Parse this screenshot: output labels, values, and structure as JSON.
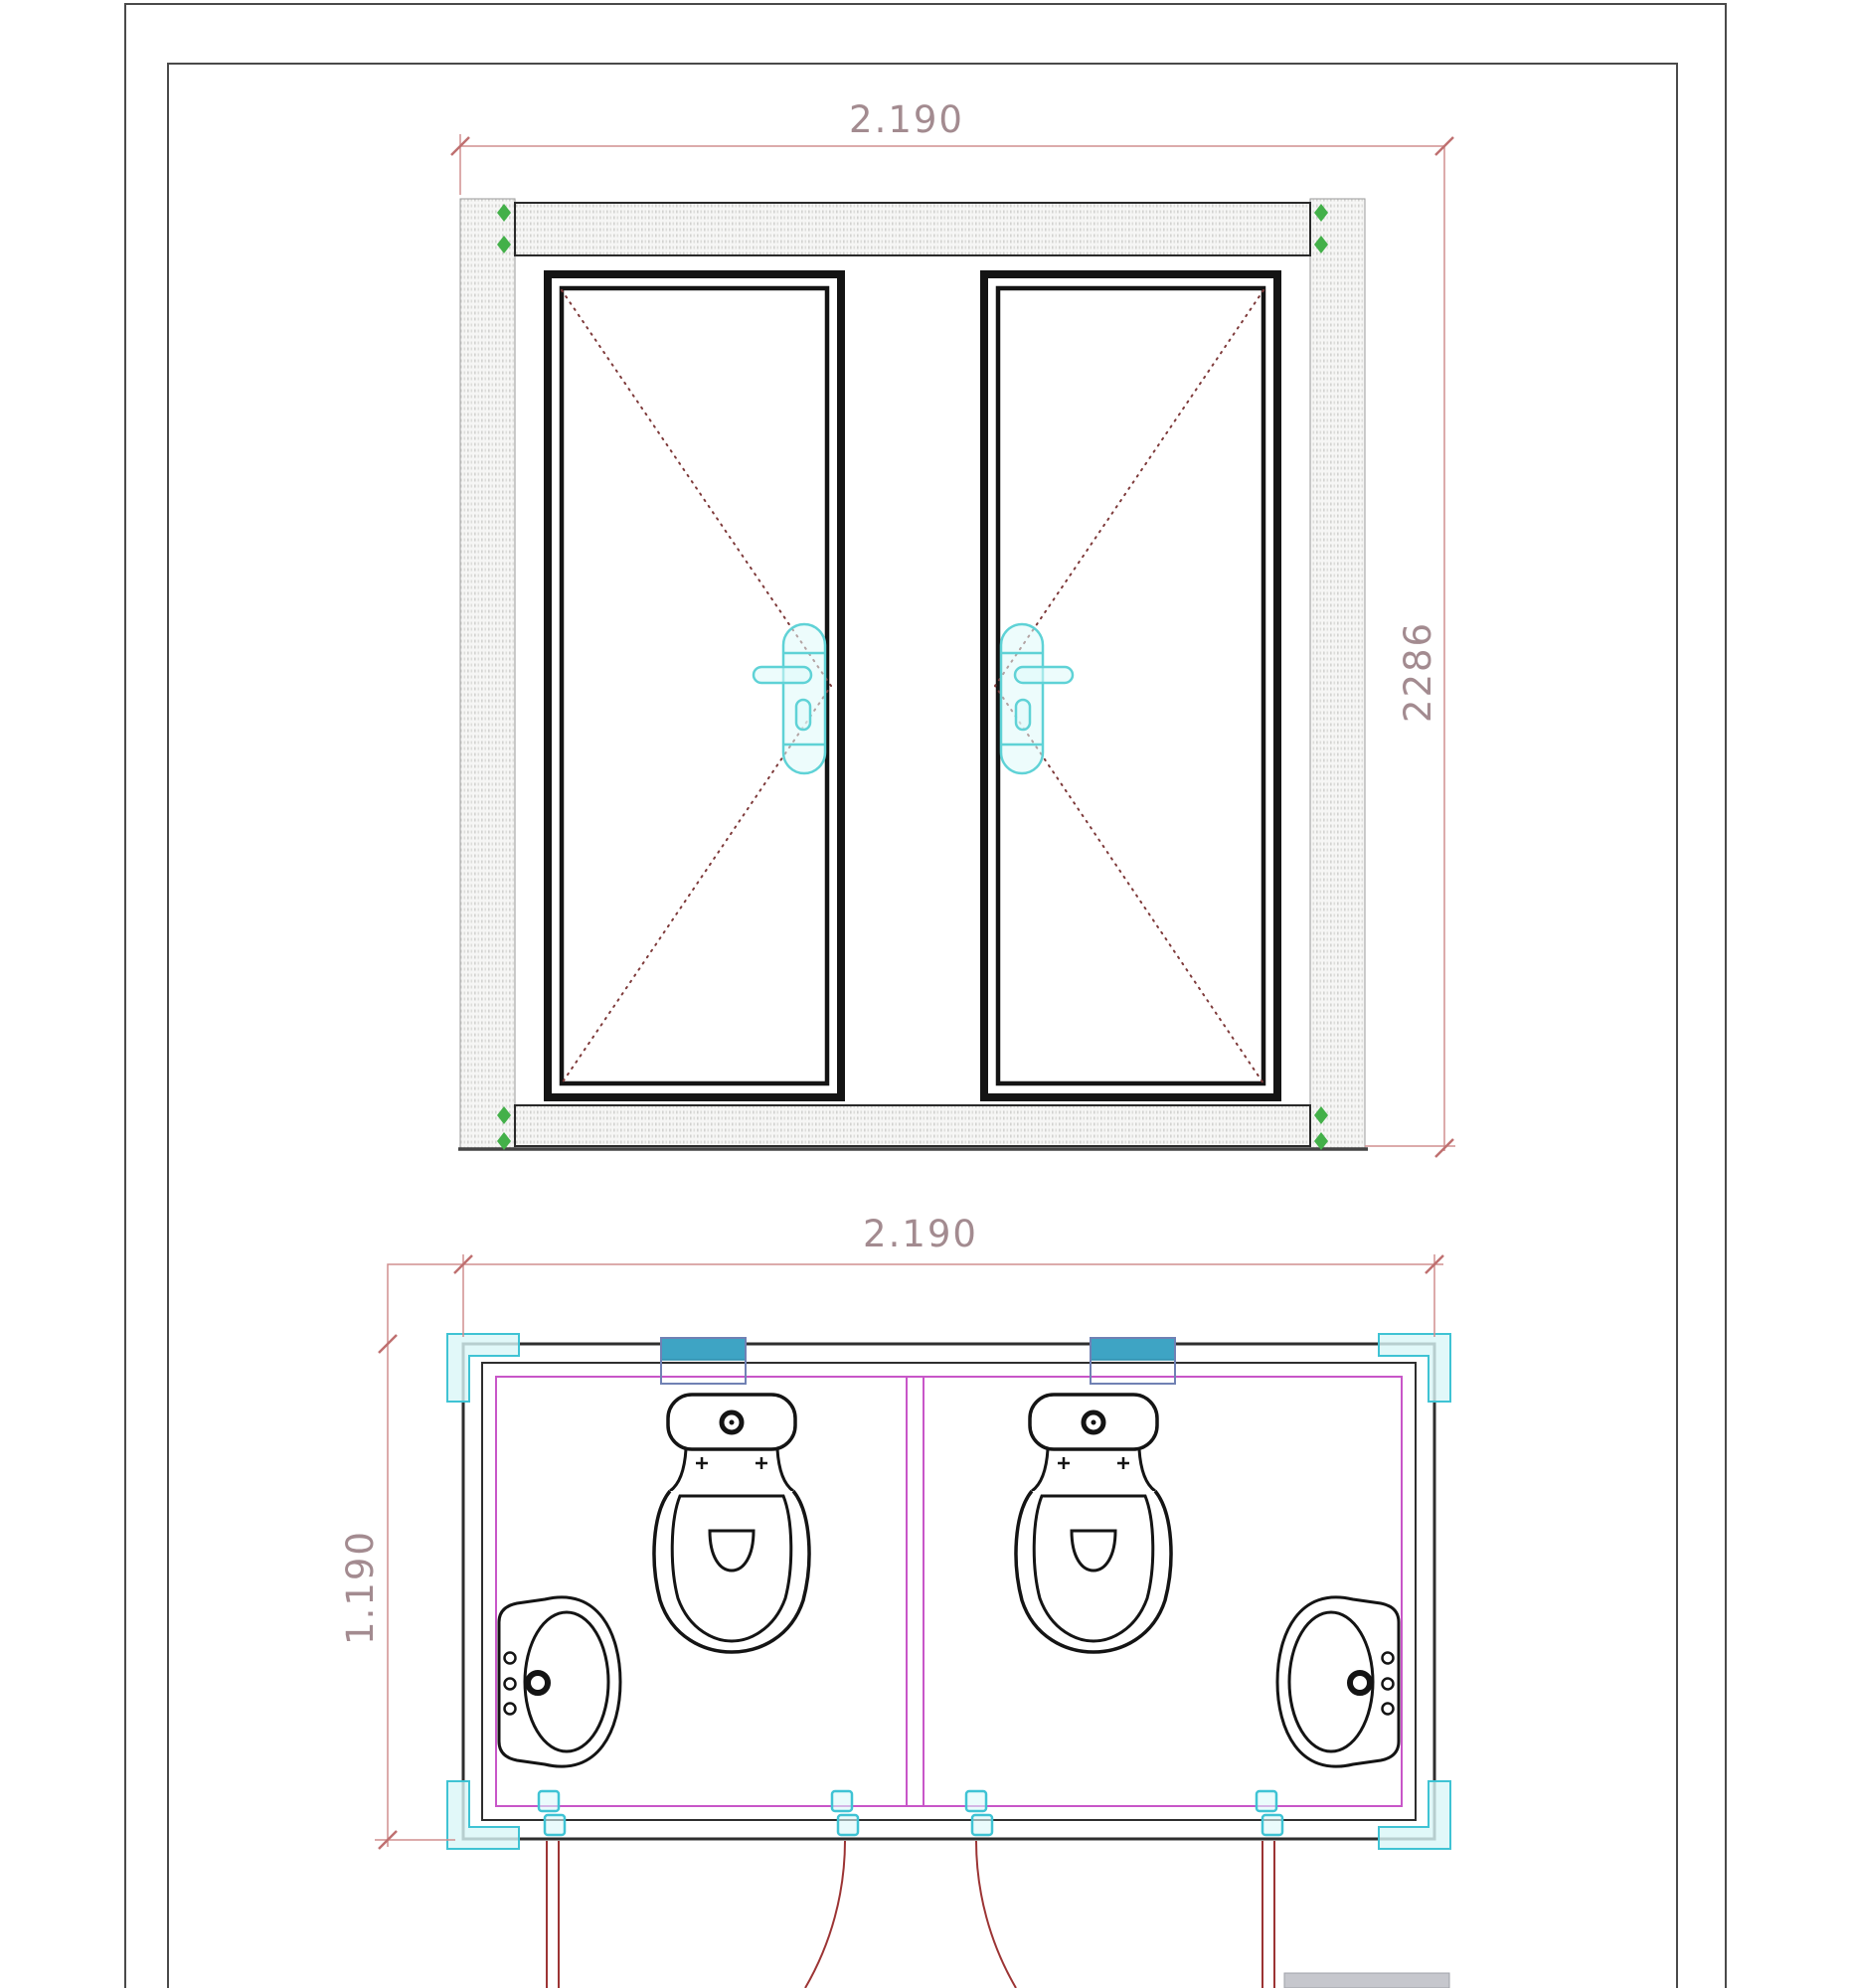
{
  "drawing": {
    "views": {
      "elevation": {
        "width_dim": "2.190",
        "height_dim": "2286"
      },
      "plan": {
        "width_dim": "2.190",
        "depth_dim": "1.190"
      }
    },
    "colors": {
      "dimension_line": "#d08f8f",
      "dimension_text": "#a38b90",
      "door_swing_red": "#9c3434",
      "diagonal_dash_maroon": "#7e3a3a",
      "hardware_cyan": "#5fd2d6",
      "plan_accent_cyan": "#3fc3d4",
      "vent_teal_fill": "#3ea4c4",
      "wall_liner_magenta": "#c856c8",
      "corner_marker_green": "#43b049",
      "linework_black": "#141414",
      "frame_hatch_gray": "#d2d2d0"
    },
    "symbols": {
      "elevation": [
        "hatched-frame",
        "door-leaf-left",
        "door-leaf-right",
        "lever-handle-left",
        "lever-handle-right",
        "green-corner-markers",
        "swing-diagonals"
      ],
      "plan": [
        "toilet-left",
        "toilet-right",
        "washbasin-left",
        "washbasin-right",
        "door-swing-left",
        "door-swing-right",
        "hinge-marks",
        "vent-boxes",
        "corner-brackets",
        "partition-wall"
      ]
    }
  }
}
